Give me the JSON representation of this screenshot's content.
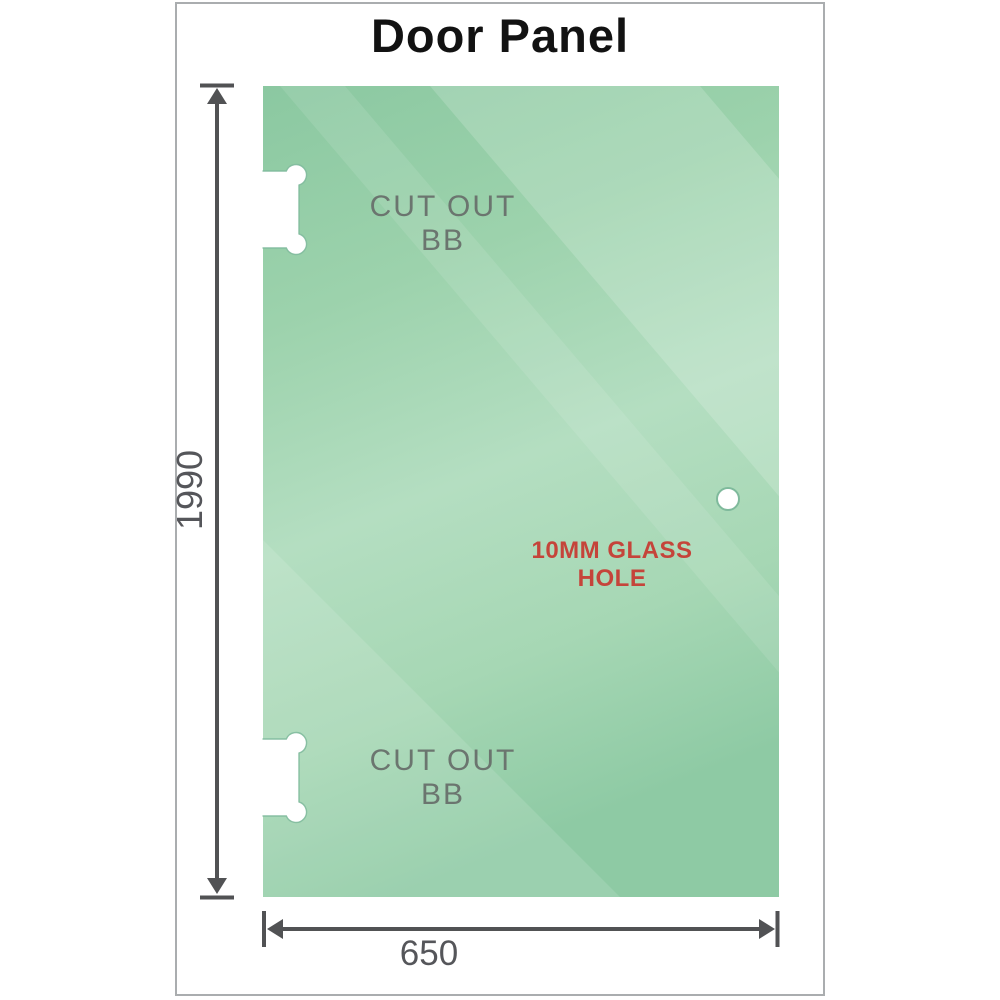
{
  "title": "Door Panel",
  "glass_panel": {
    "cutouts": [
      {
        "position": "top",
        "label": "CUT OUT BB"
      },
      {
        "position": "bottom",
        "label": "CUT OUT BB"
      }
    ],
    "hole": {
      "label": "10MM GLASS HOLE"
    }
  },
  "dimensions": {
    "height": "1990",
    "width": "650"
  },
  "colors": {
    "glass_base_top": "#8bc8a1",
    "glass_base_mid": "#b4dec1",
    "glass_base_bottom": "#8ecaa4",
    "reflection": "#ffffff",
    "dimension_line": "#515254",
    "dimension_text": "#55565a",
    "cutout_text": "#6b756f",
    "cutout_edge": "#7fba9c",
    "hole_text": "#c5443a",
    "frame_border": "#aaadaf",
    "title_text": "#121212"
  }
}
